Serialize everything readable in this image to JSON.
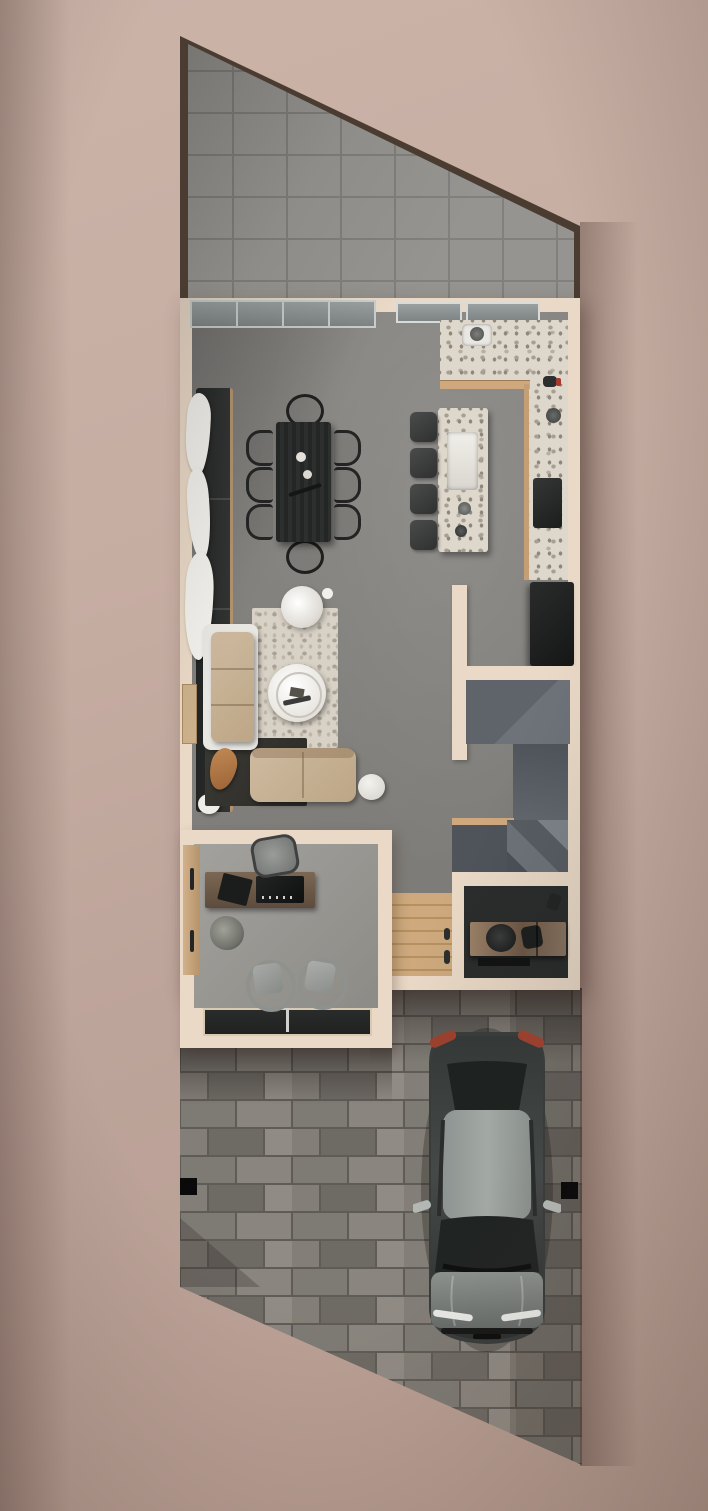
{
  "scene": {
    "title": "Top-down 3D architectural floor plan render with driveway and parked car",
    "view": "top-down",
    "rooms": [
      {
        "name": "backyard-patio",
        "floor": "large grey stone tiles",
        "enclosure": "dark brown fence, sloped north-east edge"
      },
      {
        "name": "dining-area",
        "furniture": [
          "dark wood dining table",
          "6 side chairs",
          "2 wireframe end chairs",
          "black wall bench",
          "white sheer curtains"
        ]
      },
      {
        "name": "kitchen",
        "furniture": [
          "L-shaped terrazzo counter",
          "counter sink",
          "black cooktop",
          "black refrigerator",
          "terrazzo island with farmhouse sink",
          "4 dark bar stools"
        ]
      },
      {
        "name": "living-room",
        "furniture": [
          "beige two-seat sofa with white frame",
          "beige loveseat",
          "round white coffee table",
          "round white floor lamp",
          "white pouf",
          "light terrazzo rug",
          "dark rug",
          "tan decor piece"
        ]
      },
      {
        "name": "staircase-hall",
        "furniture": [
          "slate stone steps",
          "mid landing",
          "lower winder platform",
          "wood threshold"
        ]
      },
      {
        "name": "home-office",
        "furniture": [
          "wood desk with black laptop and desk pad",
          "grey desk chair",
          "2 grey guest chairs",
          "potted plant",
          "wood door-wardrobe panel",
          "dark front glazing strip"
        ]
      },
      {
        "name": "entry-hall",
        "furniture": [
          "light oak plank floor",
          "front door"
        ]
      },
      {
        "name": "mudroom",
        "furniture": [
          "wood storage console with dark gear on top",
          "dark floor mat"
        ]
      },
      {
        "name": "driveway",
        "furniture": [
          "grey running-bond brick pavers",
          "parked dark grey sedan",
          "2 black gate posts"
        ],
        "edge": "diagonal cut at bottom-left"
      }
    ],
    "counts": {
      "dining_chairs": 8,
      "bar_stools": 4,
      "sofas": 2,
      "guest_chairs": 2,
      "gate_posts": 2,
      "cars": 1
    },
    "car": {
      "type": "sedan",
      "color": "dark grey",
      "orientation": "rear at top, front at bottom",
      "details": [
        "red taillights",
        "light grey roof",
        "dark windshields",
        "side mirrors",
        "white headlights"
      ]
    }
  },
  "palette": {
    "background": "#c6ada2",
    "background_edge": "#b19488",
    "fence": "#4a3c31",
    "patio_tile": "#8f8d89",
    "patio_grout": "#7a7875",
    "wall_cream": "#ead9c6",
    "floor_main": "#85837f",
    "floor_office": "#9b9995",
    "terrazzo_base": "#ded7cb",
    "wood_light": "#cfa87e",
    "wood_floor": "#c39a6d",
    "wood_desk": "#6f5c4a",
    "furniture_dark": "#2a2c2b",
    "sofa_beige": "#c8b197",
    "rug_light": "#d8d1c6",
    "rug_dark": "#34332f",
    "stair_slate": "#565c61",
    "brick_light": "#8a857e",
    "brick_mid": "#7e7a74",
    "brick_dark": "#6e6a64",
    "mortar": "#5f5b56",
    "car_body": "#383c3b",
    "car_roof": "#9ba19d",
    "car_glass": "#1e2221",
    "car_taillight": "#99402f",
    "accent_tan": "#b57b4a",
    "white_decor": "#efede8"
  }
}
